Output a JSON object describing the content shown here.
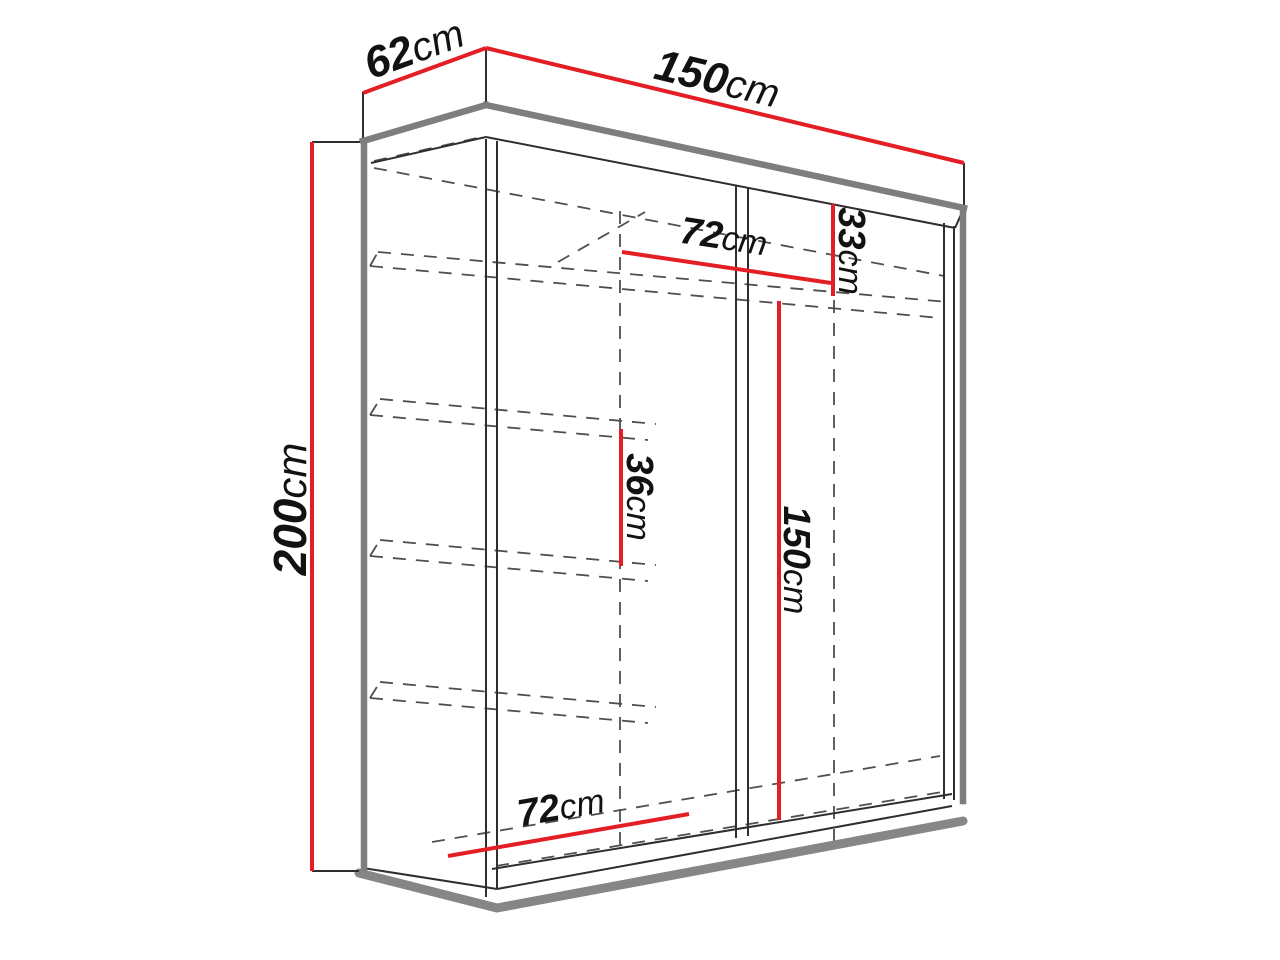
{
  "diagram": {
    "title": "wardrobe-dimension-diagram",
    "unit": "cm",
    "colors": {
      "dimension_line": "#e31e24",
      "outline": "#2e2e2e",
      "thick_edge": "#7e7e7e",
      "dashed": "#4f4f4f",
      "background": "#ffffff",
      "label_text": "#121212"
    },
    "dimensions": {
      "depth": "62",
      "width": "150",
      "height": "200",
      "top_compartment_height": "33",
      "upper_inner_width": "72",
      "shelf_spacing": "36",
      "hanging_height": "150",
      "lower_inner_width": "72"
    }
  }
}
